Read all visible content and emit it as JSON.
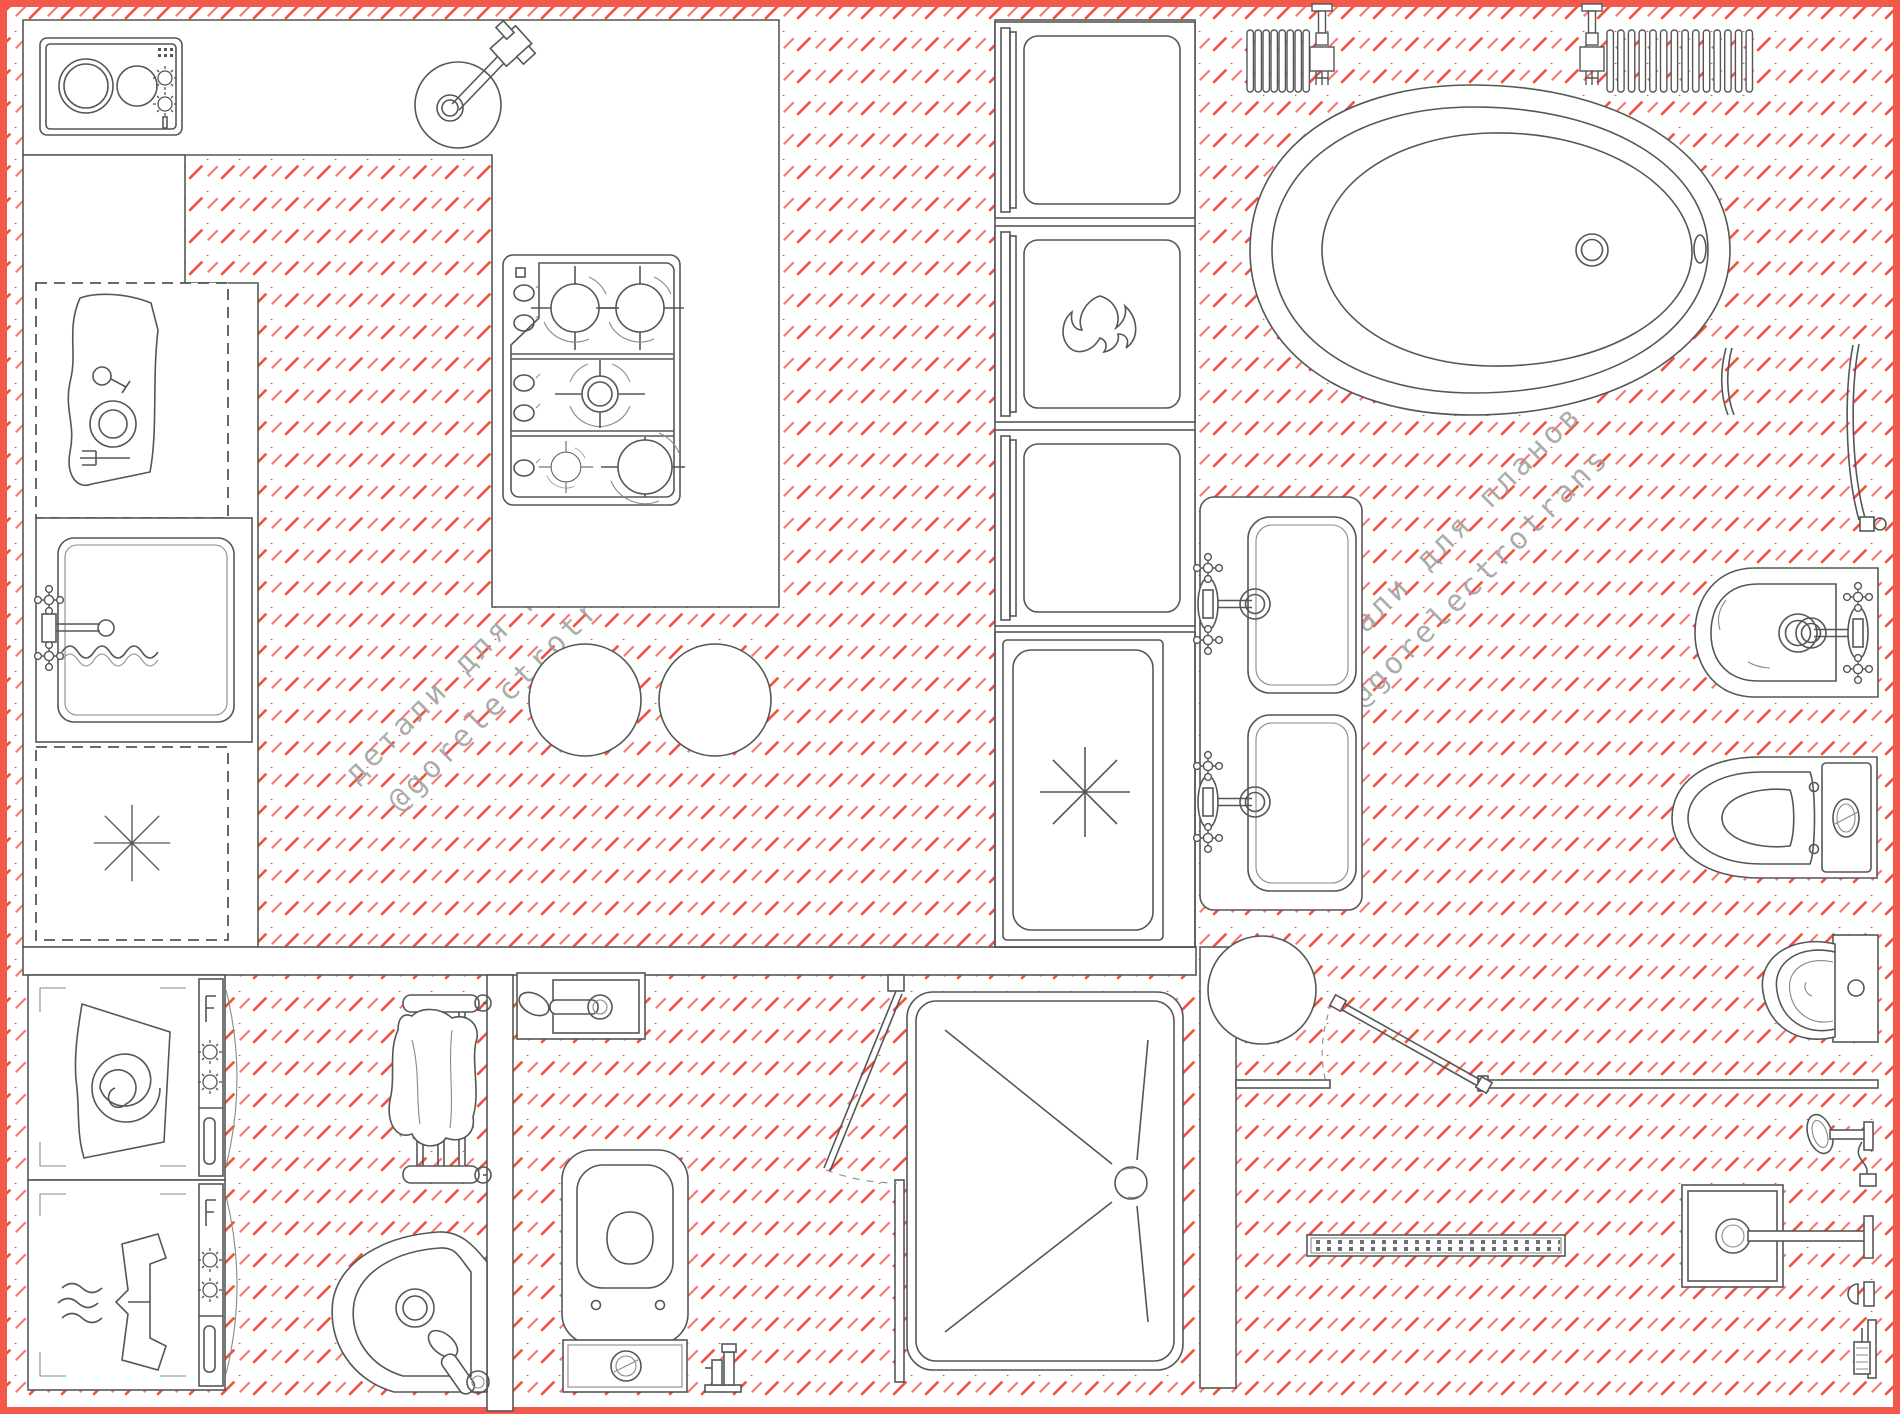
{
  "watermark": {
    "line1": "детали для планов",
    "line2": "@gorelectrotrans"
  },
  "colors": {
    "hatch_red": "#f2503d",
    "hatch_red_light": "#f8796a",
    "border_red": "#f2594b",
    "line_gray": "#565656",
    "line_light": "#8a8a8a",
    "watermark_gray": "#9e9e9e",
    "background": "#ffffff"
  },
  "drawing": {
    "type": "plan-view fixture library / floor plan",
    "floor_hatch": "red diagonal dashed hatch at 45 degrees"
  },
  "fixtures": [
    {
      "id": "cooktop-domino",
      "label": "2-burner domino cooktop"
    },
    {
      "id": "bar-sink",
      "label": "round bar sink with mixer"
    },
    {
      "id": "gas-hob",
      "label": "5-burner gas hob"
    },
    {
      "id": "dish-cabinet",
      "label": "base cabinet with dishes (dashed)"
    },
    {
      "id": "kitchen-sink",
      "label": "kitchen sink with mixer and hose"
    },
    {
      "id": "dishwasher-left",
      "label": "built-under dishwasher (dashed, asterisk)"
    },
    {
      "id": "tall-unit-1",
      "label": "tall built-in appliance"
    },
    {
      "id": "oven",
      "label": "built-in oven (flame)"
    },
    {
      "id": "tall-unit-2",
      "label": "tall built-in appliance"
    },
    {
      "id": "dishwasher",
      "label": "dishwasher with open door (asterisk)"
    },
    {
      "id": "bar-stools",
      "label": "two round bar stools"
    },
    {
      "id": "vanity-double",
      "label": "double washbasin counter with cross-handle mixers"
    },
    {
      "id": "stool-round",
      "label": "round stool"
    },
    {
      "id": "bathtub",
      "label": "freestanding oval bathtub"
    },
    {
      "id": "radiator-small",
      "label": "sectional radiator with valve"
    },
    {
      "id": "radiator-large",
      "label": "sectional radiator with valve"
    },
    {
      "id": "towel-bar-curved",
      "label": "curved wall towel bar"
    },
    {
      "id": "grab-bar-curved",
      "label": "curved grab bar with bracket"
    },
    {
      "id": "bidet-wall",
      "label": "wall-hung bidet with cross-handle mixer"
    },
    {
      "id": "toilet-horizontal",
      "label": "close-coupled WC"
    },
    {
      "id": "urinal",
      "label": "wall-hung urinal"
    },
    {
      "id": "walk-in-screens",
      "label": "walk-in shower screens with pivoting panel"
    },
    {
      "id": "hand-shower-wall",
      "label": "wall hand shower with hose"
    },
    {
      "id": "rain-shower-square",
      "label": "square rain shower head on wall arm"
    },
    {
      "id": "shower-holder",
      "label": "shower holder"
    },
    {
      "id": "hand-shower-bracket",
      "label": "hand shower in wall bracket"
    },
    {
      "id": "linear-drain",
      "label": "linear shower drain channel"
    },
    {
      "id": "washing-machine",
      "label": "washing machine (drum spiral)"
    },
    {
      "id": "tumble-dryer",
      "label": "tumble dryer (shirt)"
    },
    {
      "id": "towel-ladder",
      "label": "towel rail with draped towel"
    },
    {
      "id": "wall-mixer",
      "label": "wall-mounted basin mixer in niche"
    },
    {
      "id": "corner-basin",
      "label": "corner washbasin with mixer"
    },
    {
      "id": "toilet-vertical",
      "label": "WC with bottom cistern unit"
    },
    {
      "id": "floor-tap",
      "label": "small floor outlet / tap"
    },
    {
      "id": "shower-tray",
      "label": "shower tray with pivot door and linear slopes"
    }
  ]
}
